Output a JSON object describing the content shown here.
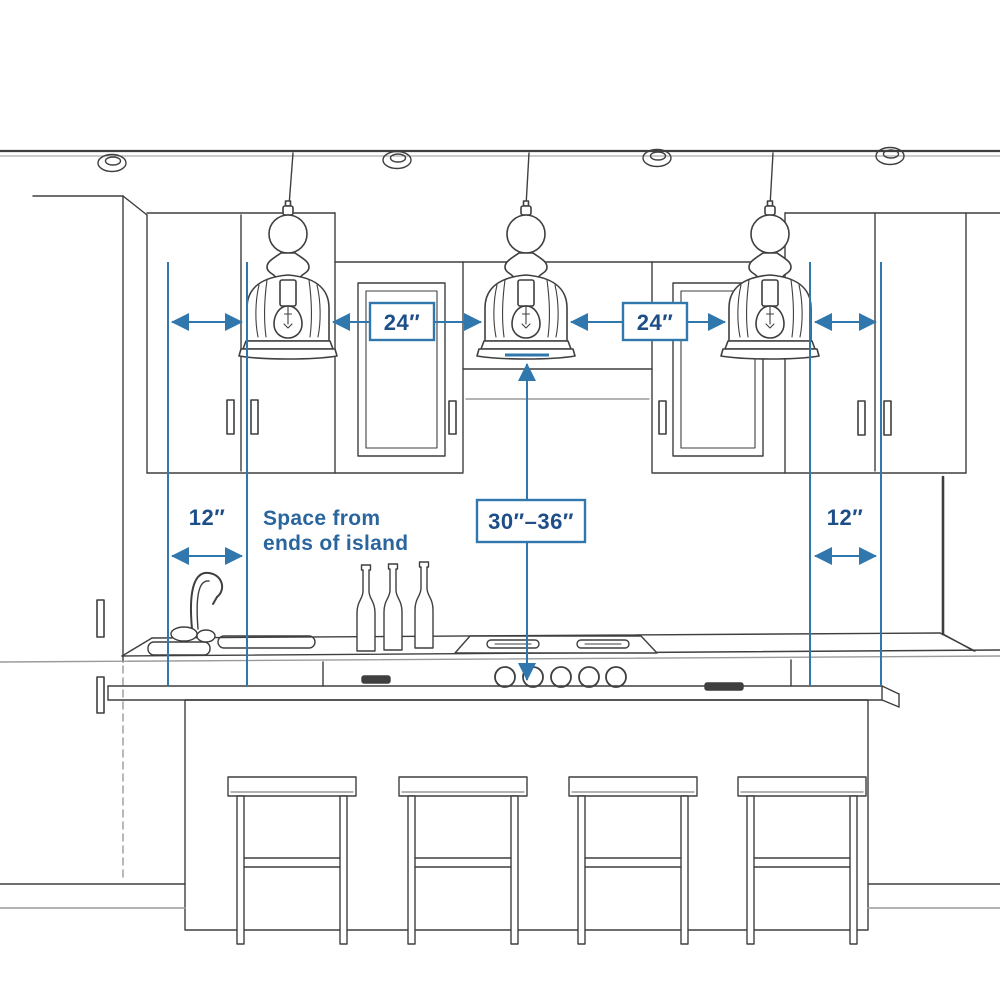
{
  "diagram": {
    "type": "kitchen-island-pendant-spacing-guide",
    "labels": {
      "pendant_gap_left": "24″",
      "pendant_gap_right": "24″",
      "island_end_left": "12″",
      "island_end_right": "12″",
      "hang_height": "30″–36″",
      "note_line1": "Space from",
      "note_line2": "ends of island"
    },
    "colors": {
      "dimension_line": "#3077ad",
      "dimension_label_text": "#1d4e88",
      "note_text": "#2a659e",
      "sketch_line": "#3f3f3f",
      "sketch_line_light": "#9a9a9a",
      "background": "#ffffff"
    }
  }
}
